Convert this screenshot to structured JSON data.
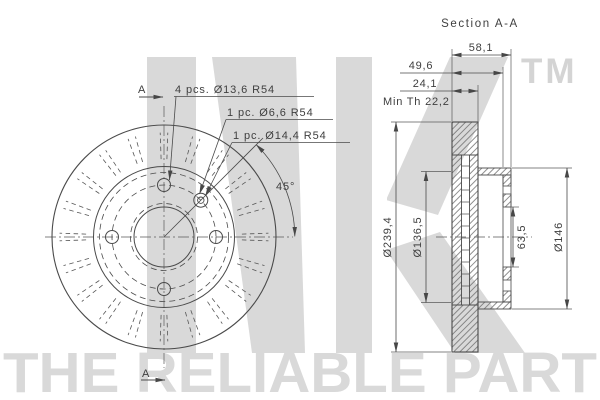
{
  "colors": {
    "line": "#4a4a4a",
    "thin_line": "#5a5a5a",
    "watermark": "#d9d9d9"
  },
  "watermark": {
    "logo": "NK",
    "tm": "TM",
    "tagline": "THE RELIABLE PART"
  },
  "section_view": {
    "title": "Section A-A",
    "dims": {
      "total_height": "58,1",
      "inner_height": "49,6",
      "thickness": "24,1",
      "min_thickness": "Min Th 22,2",
      "outer_diameter": "Ø239,4",
      "friction_inner_diameter": "Ø136,5",
      "bore_diameter": "63,5",
      "hub_diameter": "Ø146"
    }
  },
  "front_view": {
    "labels": {
      "bolt_holes": "4 pcs. Ø13,6 R54",
      "pin_hole_small": "1 pc. Ø6,6 R54",
      "pin_hole_large": "1 pc. Ø14,4 R54",
      "angle": "45°"
    },
    "section_marker_top": "A",
    "section_marker_bottom": "A"
  }
}
